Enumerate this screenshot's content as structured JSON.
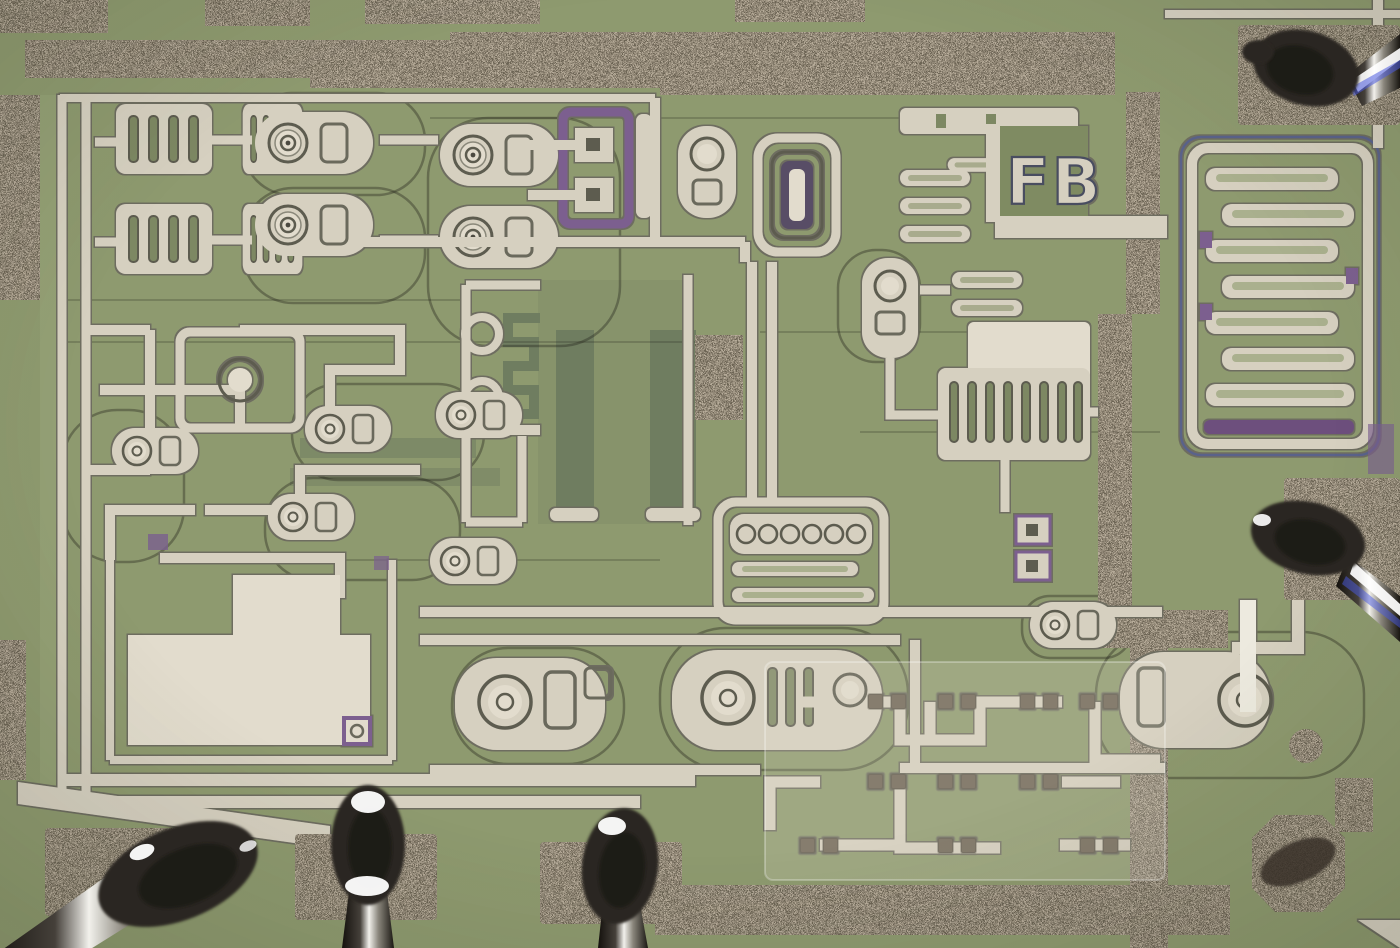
{
  "scene": {
    "type": "photomicrograph",
    "subject": "silicon integrated-circuit die under microscope with tungsten probe needles landed on pads",
    "technology": "bipolar analog IC (circular-emitter transistors, diffused resistors, metal interconnect)"
  },
  "labels": {
    "mask_label": "FB"
  },
  "colors": {
    "substrate_green": "#8E9A6F",
    "diffusion_dark": "#6F7D60",
    "diffusion_mid": "#83906A",
    "metal_cream": "#D6D0C0",
    "metal_bright": "#E2DCCD",
    "grain_tan": "#B6AB99",
    "outline_dark": "#75746A",
    "via_purple": "#7B5F8F",
    "needle_dark": "#2B2620",
    "highlight_white": "#FFFFFF",
    "needle_blue_sheen": "#4A5ADF"
  },
  "structures": [
    {
      "name": "top-metal-bus",
      "desc": "wide grainy metallization bus across the top of the die"
    },
    {
      "name": "right-metal-bus",
      "desc": "vertical grainy bus running down the right-center"
    },
    {
      "name": "bottom-metal-bus",
      "desc": "grainy bus along the bottom-right edge"
    },
    {
      "name": "serpentine-resistor",
      "desc": "seven-bar serpentine thin-film resistor, upper right"
    },
    {
      "name": "mask-label",
      "desc": "metal mask designator FB"
    },
    {
      "name": "striped-resistor-bank",
      "desc": "interdigitated diffused resistor stripes, upper left"
    },
    {
      "name": "round-emitter-transistors",
      "desc": "circular-emitter bipolar transistors in D-shaped isolation"
    },
    {
      "name": "diffusion-resistor-pair",
      "desc": "two dark diffused resistor bars with meander link, die center"
    },
    {
      "name": "multi-emitter-transistor",
      "desc": "seven-dot multi-emitter device, center"
    },
    {
      "name": "comb-transistor",
      "desc": "slotted interdigitated power device, right-center"
    },
    {
      "name": "capacitor-plate",
      "desc": "large bright metal plate, lower left"
    },
    {
      "name": "small-signal-cluster",
      "desc": "grid of small contacts under translucent plate, lower right"
    },
    {
      "name": "bond-pad-1",
      "desc": "probed pad, bottom left"
    },
    {
      "name": "bond-pad-2",
      "desc": "probed pad, bottom center-left"
    },
    {
      "name": "bond-pad-3",
      "desc": "probed pad, bottom center"
    },
    {
      "name": "probe-pad-top-right",
      "desc": "probed pad, top right corner"
    },
    {
      "name": "probe-pad-right",
      "desc": "probed pad, right edge"
    },
    {
      "name": "octagon-pad",
      "desc": "octagonal contact with probe scrub mark, bottom right"
    },
    {
      "name": "probe-needle",
      "count": 5,
      "desc": "dark tungsten probe tips with bright specular reflections"
    }
  ]
}
